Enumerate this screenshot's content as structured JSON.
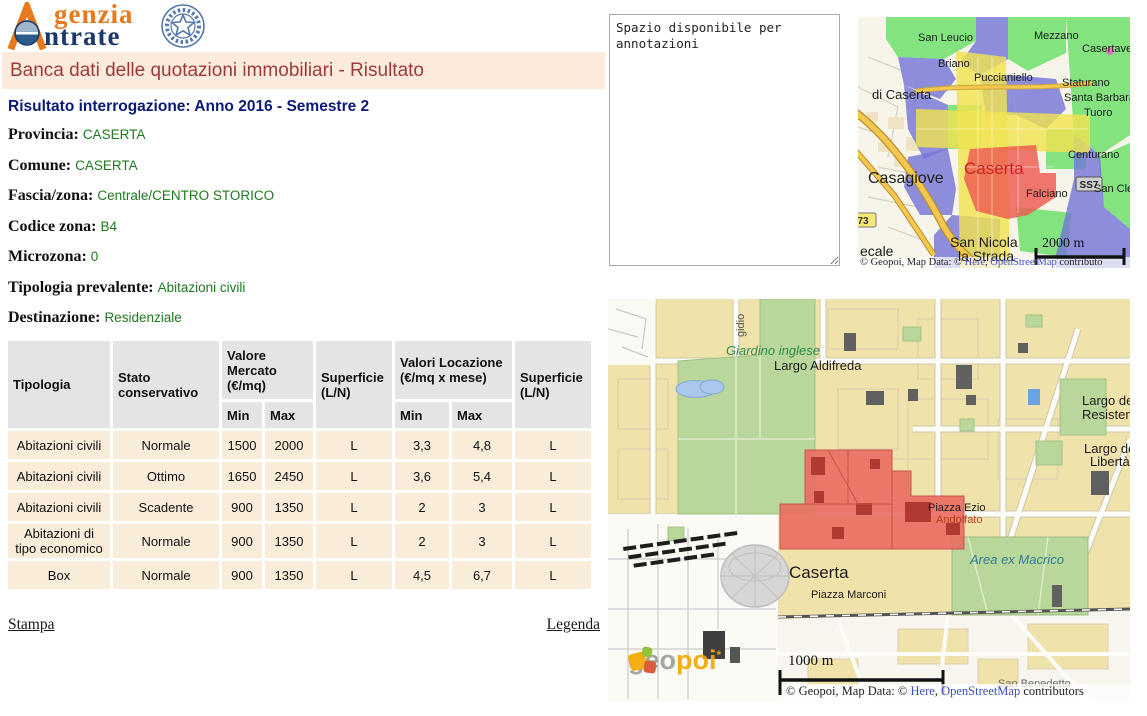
{
  "logo": {
    "line1": "genzia",
    "line2": "ntrate"
  },
  "page_title": "Banca dati delle quotazioni immobiliari - Risultato",
  "result_heading": "Risultato interrogazione: Anno 2016 - Semestre 2",
  "fields": [
    {
      "label": "Provincia:",
      "value": "CASERTA"
    },
    {
      "label": "Comune:",
      "value": "CASERTA"
    },
    {
      "label": "Fascia/zona:",
      "value": "Centrale/CENTRO STORICO"
    },
    {
      "label": "Codice zona:",
      "value": "B4"
    },
    {
      "label": "Microzona:",
      "value": "0"
    },
    {
      "label": "Tipologia prevalente:",
      "value": "Abitazioni civili"
    },
    {
      "label": "Destinazione:",
      "value": "Residenziale"
    }
  ],
  "table": {
    "headers": {
      "tipologia": "Tipologia",
      "stato": "Stato conservativo",
      "valore_mercato": "Valore Mercato (€/mq)",
      "superficie_1": "Superficie (L/N)",
      "valori_locazione": "Valori Locazione (€/mq x mese)",
      "superficie_2": "Superficie (L/N)",
      "min_1": "Min",
      "max_1": "Max",
      "min_2": "Min",
      "max_2": "Max"
    },
    "rows": [
      [
        "Abitazioni civili",
        "Normale",
        "1500",
        "2000",
        "L",
        "3,3",
        "4,8",
        "L"
      ],
      [
        "Abitazioni civili",
        "Ottimo",
        "1650",
        "2450",
        "L",
        "3,6",
        "5,4",
        "L"
      ],
      [
        "Abitazioni civili",
        "Scadente",
        "900",
        "1350",
        "L",
        "2",
        "3",
        "L"
      ],
      [
        "Abitazioni di tipo economico",
        "Normale",
        "900",
        "1350",
        "L",
        "2",
        "3",
        "L"
      ],
      [
        "Box",
        "Normale",
        "900",
        "1350",
        "L",
        "4,5",
        "6,7",
        "L"
      ]
    ]
  },
  "links": {
    "stampa": "Stampa",
    "legenda": "Legenda"
  },
  "annotations": {
    "value": "Spazio disponibile per annotazioni"
  },
  "colors": {
    "accent_orange": "#e87a1e",
    "accent_navy": "#1b3a6b",
    "title_red": "#9c3a3a",
    "value_green": "#1d7a1d",
    "row_bg": "#f9ecd9",
    "header_bg": "#e4e4e4",
    "zone_red": "#ee5a4f",
    "zone_blue": "#7576d8",
    "zone_green": "#68df68",
    "zone_yellow": "#f0e352"
  },
  "maps": {
    "small": {
      "scale_label": "2000 m",
      "badges": {
        "ss7": "SS7",
        "sp73": "73"
      },
      "labels": [
        {
          "t": "San Leucio"
        },
        {
          "t": "Mezzano"
        },
        {
          "t": "Casertavecc"
        },
        {
          "t": "Briano"
        },
        {
          "t": "Puccianiello"
        },
        {
          "t": "Staturano"
        },
        {
          "t": "Santa Barbara"
        },
        {
          "t": "Tuoro"
        },
        {
          "t": "di Caserta"
        },
        {
          "t": "Casagiove"
        },
        {
          "t": "Caserta"
        },
        {
          "t": "Centurano"
        },
        {
          "t": "Falciano"
        },
        {
          "t": "San Cleme"
        },
        {
          "t": "ecale"
        },
        {
          "t": "San Nicola"
        },
        {
          "t": "la Strada"
        }
      ],
      "attribution": {
        "prefix": "© Geopoi, Map Data: © ",
        "here": "Here",
        "sep": ", ",
        "osm": "OpenStreetMap",
        "suffix": " contributo"
      }
    },
    "large": {
      "scale_label": "1000 m",
      "watermark": {
        "geo": "geo",
        "poi": "poi",
        "mark": "*"
      },
      "labels": [
        {
          "t": "gidio"
        },
        {
          "t": "Giardino inglese"
        },
        {
          "t": "Largo Aldifreda"
        },
        {
          "t": "Largo dell"
        },
        {
          "t": "Resistenz"
        },
        {
          "t": "Largo dell"
        },
        {
          "t": "Libertà"
        },
        {
          "t": "Piazza Ezio"
        },
        {
          "t": "Andolfato"
        },
        {
          "t": "Area ex Macrico"
        },
        {
          "t": "Caserta"
        },
        {
          "t": "Piazza Marconi"
        },
        {
          "t": "San Benedetto"
        }
      ],
      "attribution": {
        "prefix": "© Geopoi, Map Data: © ",
        "here": "Here",
        "sep": ", ",
        "osm": "OpenStreetMap",
        "suffix": " contributors"
      }
    }
  }
}
